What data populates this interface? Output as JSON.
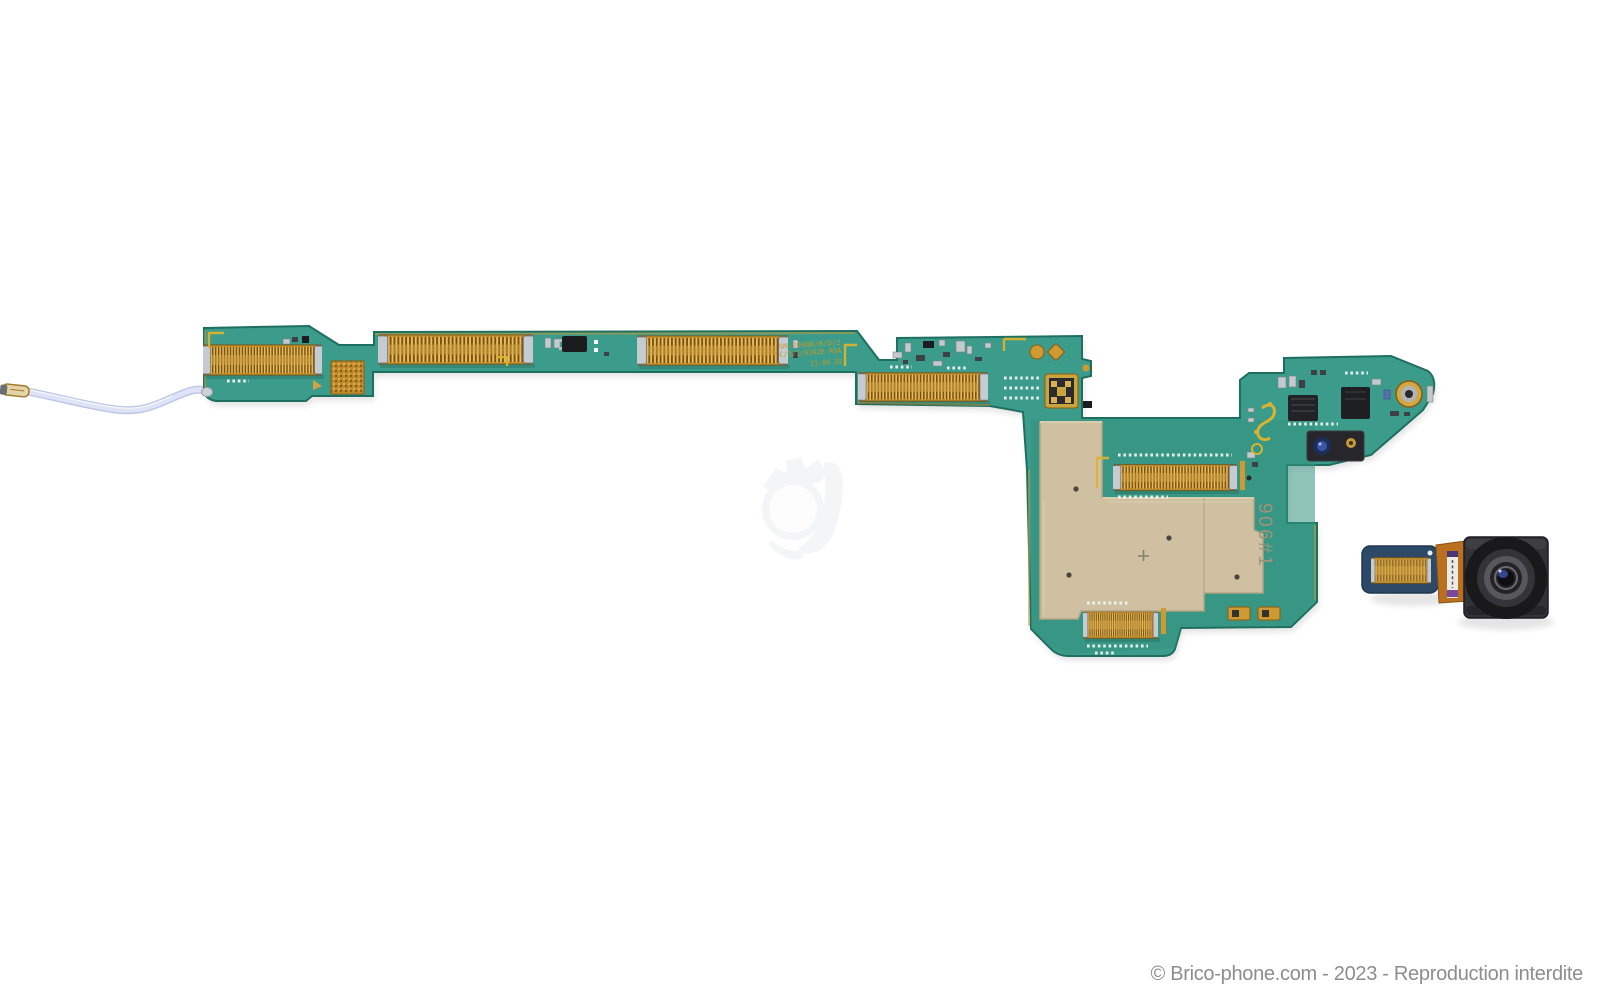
{
  "watermark": {
    "text": "© Brico-phone.com - 2023 - Reproduction interdite"
  },
  "board": {
    "silkscreen_line1": "SM-F9080/B/D/2",
    "silkscreen_line2": "C/3/1/9302B R0A",
    "silkscreen_line3": "21.04.30",
    "shield_marking": "906#1"
  },
  "colors": {
    "pcb": "#3b9c8b",
    "pcb2": "#35937f",
    "pcbEdge": "#1f6f60",
    "gold": "#d2a345",
    "goldMid": "#c6922c",
    "goldDark": "#7d5211",
    "goldBright": "#e6bd5e",
    "silver": "#c6cbd0",
    "silverDark": "#70767c",
    "shield": "#cec0a1",
    "shieldHi": "#ddd2b4",
    "shieldLo": "#b3a584",
    "shieldInk": "#a2937a",
    "silk": "#d9b331",
    "whiteSilk": "#f2f7f5",
    "cable": "#dfe3f6",
    "cableEdge": "#c0c7e8",
    "ink": "#8d8d8d",
    "logo": "#eceff1",
    "camBody": "#323237",
    "flexOrange": "#b9701f",
    "flexPad": "#2c4a67",
    "chipBlack": "#1b1c1f",
    "partSilver": "#c3c9cd",
    "partDark": "#3c4146"
  }
}
